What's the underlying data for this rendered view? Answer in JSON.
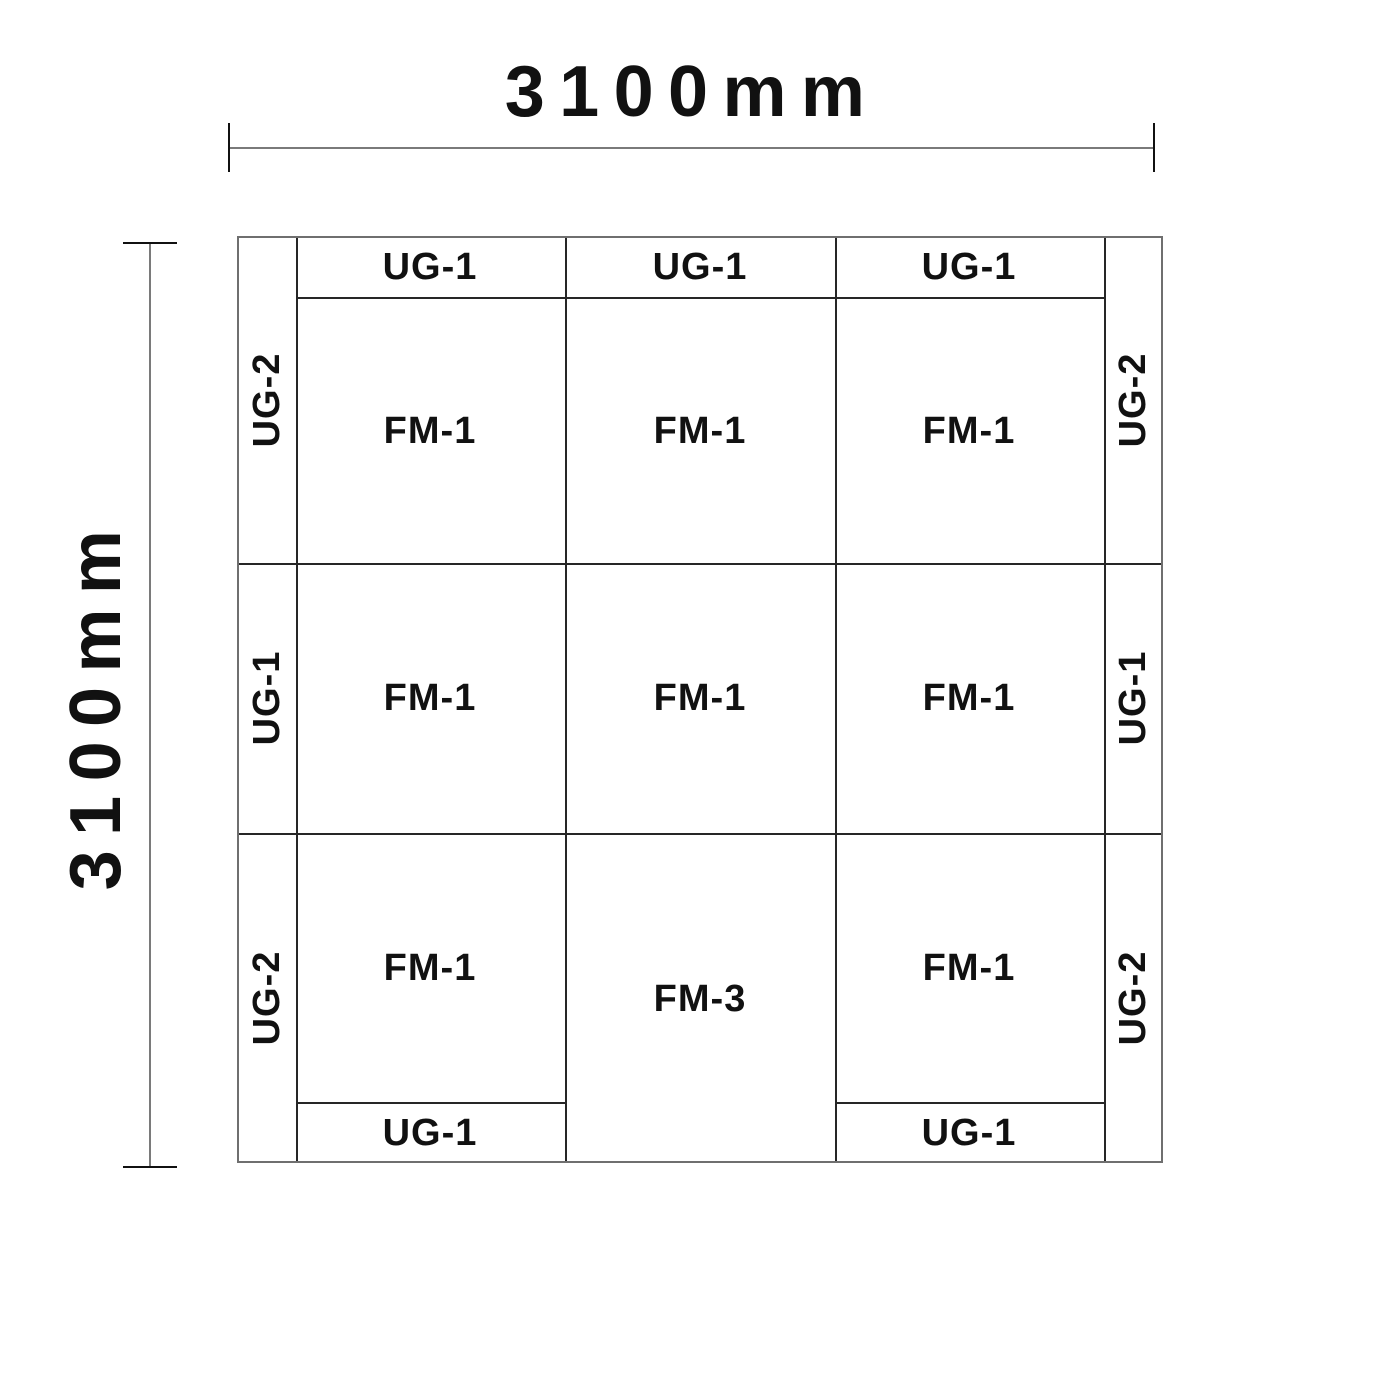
{
  "title": "Panel layout drawing 3100mm x 3100mm",
  "dimensions": {
    "top": {
      "label": "3100mm"
    },
    "left": {
      "label": "3100mm"
    }
  },
  "grid": {
    "top_strip": [
      "UG-1",
      "UG-1",
      "UG-1"
    ],
    "left_strip": [
      "UG-2",
      "UG-1",
      "UG-2"
    ],
    "right_strip": [
      "UG-2",
      "UG-1",
      "UG-2"
    ],
    "bottom_strip": [
      "UG-1",
      "UG-1"
    ],
    "rows": [
      [
        "FM-1",
        "FM-1",
        "FM-1"
      ],
      [
        "FM-1",
        "FM-1",
        "FM-1"
      ],
      [
        "FM-1",
        "FM-3",
        "FM-1"
      ]
    ]
  },
  "colors": {
    "background": "#ffffff",
    "text": "#111111",
    "outer_border": "#6f6f6f",
    "inner_line": "#262626",
    "dimension_line": "#7a7a7a",
    "tick": "#111111"
  }
}
